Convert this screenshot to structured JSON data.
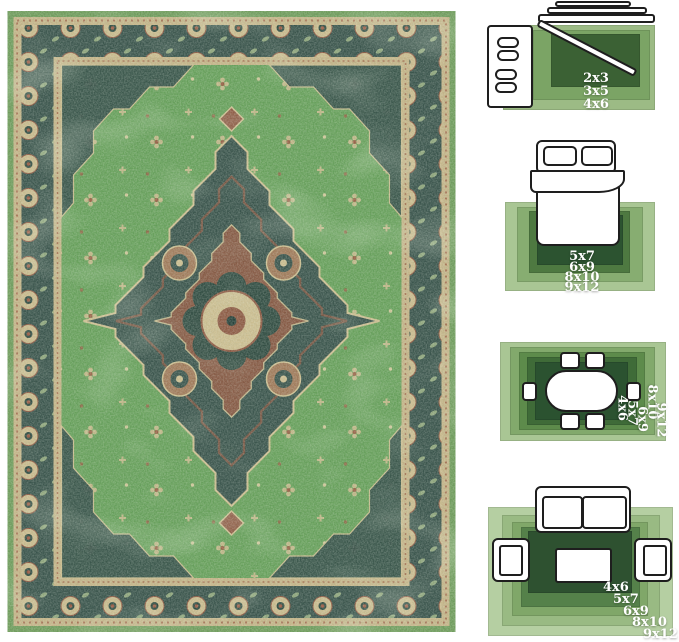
{
  "canvas": {
    "width": 679,
    "height": 642,
    "background": "#ffffff"
  },
  "rug_photo": {
    "description": "vintage distressed green oriental medallion rug",
    "palette": {
      "edge_green": "#6f9c5c",
      "field_green": "#67a05b",
      "border_teal": "#3a544c",
      "tan": "#c4b488",
      "rust": "#8d5a44",
      "dark_accent": "#27413a",
      "worn_mint": "#cfe0ba"
    }
  },
  "label_text_color": "#ffffff",
  "size_guides": [
    {
      "name": "entryway",
      "sizes": [
        "2x3",
        "3x5",
        "4x6"
      ],
      "ring_colors": [
        "#9cbb85",
        "#7ba465",
        "#3b6134"
      ]
    },
    {
      "name": "bedroom",
      "sizes": [
        "5x7",
        "6x9",
        "8x10",
        "9x12"
      ],
      "ring_colors": [
        "#a9c694",
        "#87ad71",
        "#4e7941",
        "#2c5330"
      ]
    },
    {
      "name": "dining-room",
      "sizes": [
        "4x6",
        "5x7",
        "6x9",
        "8x10",
        "9x12"
      ],
      "ring_colors": [
        "#a9c694",
        "#82a96c",
        "#5d8b4b",
        "#3f6b38",
        "#2b5230"
      ]
    },
    {
      "name": "living-room",
      "sizes": [
        "4x6",
        "5x7",
        "6x9",
        "8x10",
        "9x12"
      ],
      "ring_colors": [
        "#b5cfa2",
        "#99ba83",
        "#80a769",
        "#55814a",
        "#2e5130"
      ]
    }
  ]
}
